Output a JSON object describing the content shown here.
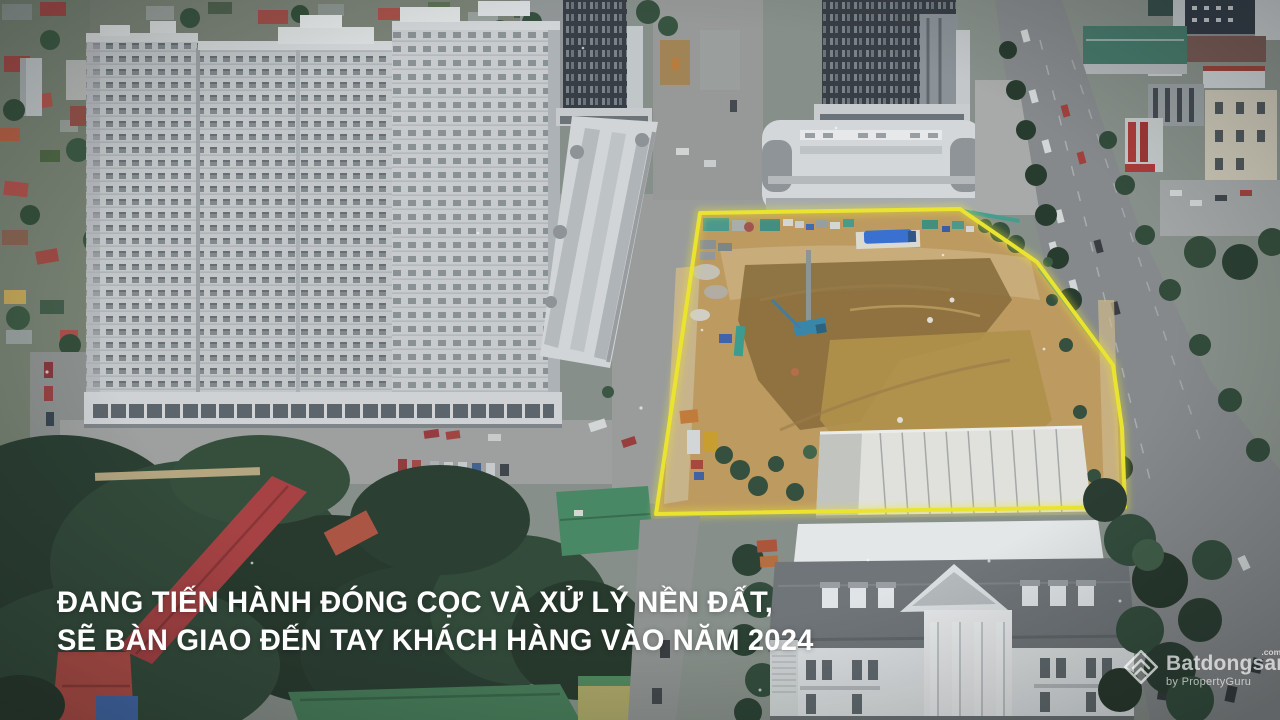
{
  "frame": {
    "kind": "drone-aerial-video-frame",
    "width": 1280,
    "height": 720
  },
  "caption": {
    "line1": "ĐANG TIẾN HÀNH ĐÓNG CỌC VÀ XỬ LÝ NỀN ĐẤT,",
    "line2": "SẼ BÀN GIAO ĐẾN TAY KHÁCH HÀNG VÀO NĂM 2024",
    "color": "#ffffff"
  },
  "watermark": {
    "brand": "Batdongsan",
    "domain_suffix": ".com.vn",
    "byline": "by PropertyGuru",
    "logo_icon": "batdongsan-diamond-chevron-icon",
    "color": "#ffffff"
  },
  "scene": {
    "description": "Aerial view of an urban construction site highlighted with a glowing yellow boundary, flanked by white apartment towers, shophouse rows, dark high-rise towers, a tree-lined boulevard, a white classical palace building and a low-rise neighborhood",
    "site_outline_color": "#f5ec18",
    "palette": {
      "earth": "#c59c57",
      "earth_dark": "#8a682f",
      "tower_light": "#c7cbcf",
      "tower_dark": "#31383f",
      "road": "#85898b",
      "foliage": "#23392b",
      "red_roof": "#b23a3c",
      "green_roof": "#3f7d52",
      "palace": "#e4e7e9",
      "machine_blue": "#2f6ede"
    }
  }
}
